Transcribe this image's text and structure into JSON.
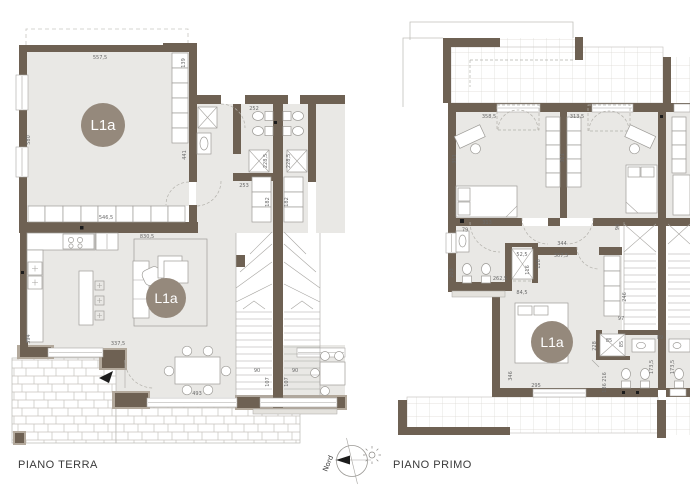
{
  "plans": {
    "terra": {
      "title": "PIANO TERRA",
      "badges": [
        "L1a",
        "L1a"
      ],
      "dims": [
        "557,5",
        "139",
        "580",
        "441",
        "546,5",
        "830,5",
        "252",
        "228,5",
        "228,5",
        "253",
        "182",
        "182",
        "394",
        "337,5",
        "493",
        "90",
        "90",
        "107",
        "107"
      ]
    },
    "primo": {
      "title": "PIANO PRIMO",
      "badges": [
        "L1a"
      ],
      "dims": [
        "358,5",
        "351",
        "313,5",
        "361",
        "313",
        "79",
        "203",
        "262,5",
        "52,5",
        "116",
        "128",
        "84,5",
        "344",
        "307,5",
        "96",
        "246",
        "97",
        "85",
        "85",
        "228",
        "89",
        "216",
        "186",
        "346",
        "295",
        "173,5",
        "173,5"
      ]
    },
    "compass": {
      "north_label": "Nord"
    }
  },
  "colors": {
    "wall": "#6e6153",
    "wall_light": "#b3a99c",
    "floor": "#e9e8e5",
    "badge": "#95897c",
    "tile_line": "#dbd9d4",
    "paving_line": "#c6c3bd",
    "dim_text": "#6a6a6a",
    "title_text": "#3a3a3a"
  }
}
